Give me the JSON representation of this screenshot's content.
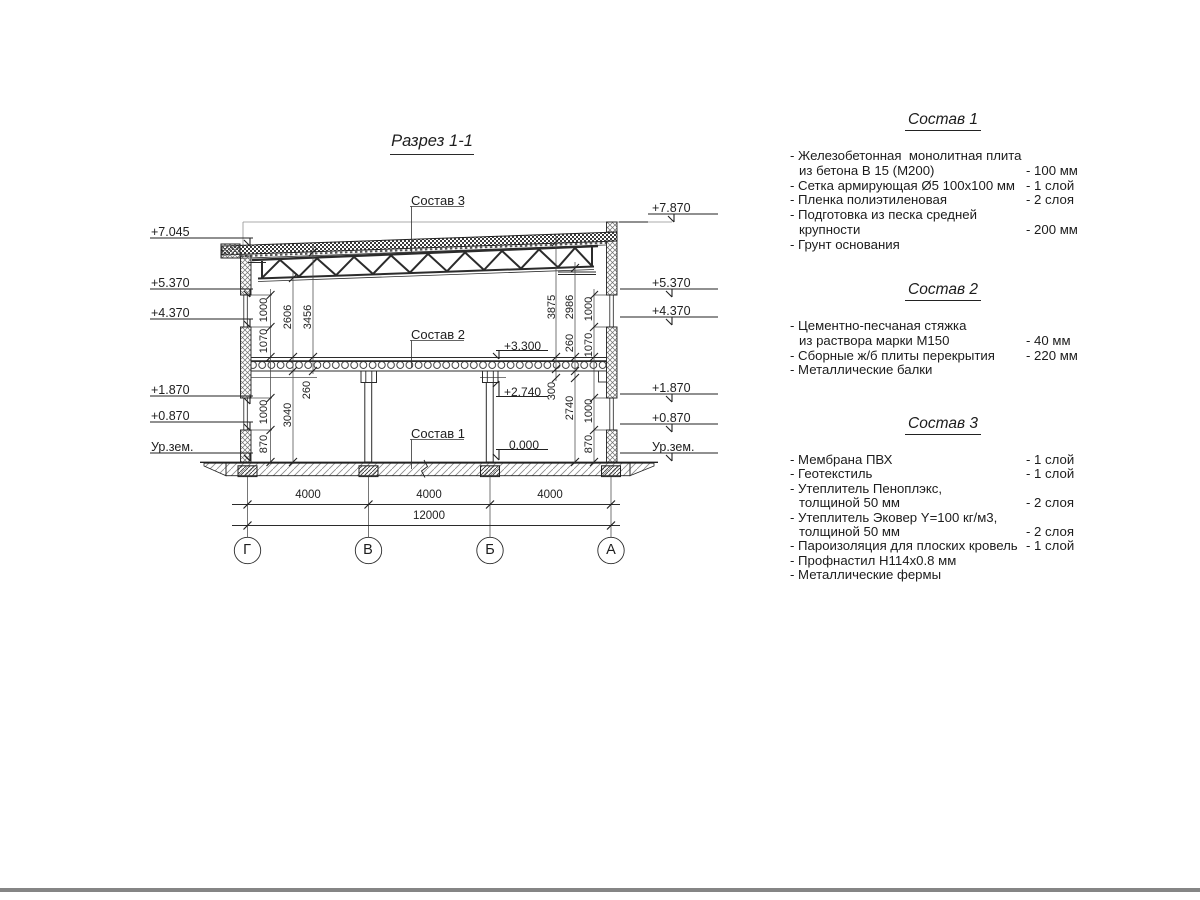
{
  "ink_color": "#222222",
  "bottom_edge_color": "#858585",
  "drawing": {
    "title": "Разрез 1-1",
    "levels_left": [
      "+7.045",
      "+5.370",
      "+4.370",
      "+1.870",
      "+0.870",
      "Ур.зем."
    ],
    "levels_right": [
      "+7.870",
      "+5.370",
      "+4.370",
      "+1.870",
      "+0.870",
      "Ур.зем."
    ],
    "levels_internal": [
      "+3.300",
      "+2.740",
      "0.000"
    ],
    "callouts": [
      "Состав 3",
      "Состав 2",
      "Состав 1"
    ],
    "dims_left": [
      "1000",
      "1070",
      "2606",
      "3456",
      "260",
      "3040",
      "1000",
      "870"
    ],
    "dims_right": [
      "3875",
      "2986",
      "1000",
      "260",
      "1070",
      "300",
      "2740",
      "1000",
      "870"
    ],
    "dims_bottom": [
      "4000",
      "4000",
      "4000",
      "12000"
    ],
    "axes": [
      "Г",
      "В",
      "Б",
      "А"
    ]
  },
  "lists": [
    {
      "title": "Состав 1",
      "rows": [
        {
          "t": "- Железобетонная  монолитная плита",
          "v": ""
        },
        {
          "t": "из бетона В 15 (М200)",
          "v": "- 100 мм"
        },
        {
          "t": "- Сетка армирующая Ø5 100х100 мм",
          "v": "- 1 слой"
        },
        {
          "t": "- Пленка полиэтиленовая",
          "v": "- 2 слоя"
        },
        {
          "t": "- Подготовка из песка средней",
          "v": ""
        },
        {
          "t": "крупности",
          "v": "- 200 мм"
        },
        {
          "t": "- Грунт основания",
          "v": ""
        }
      ]
    },
    {
      "title": "Состав 2",
      "rows": [
        {
          "t": "- Цементно-песчаная стяжка",
          "v": ""
        },
        {
          "t": "из раствора марки М150",
          "v": "- 40 мм"
        },
        {
          "t": "- Сборные ж/б плиты перекрытия",
          "v": "- 220 мм"
        },
        {
          "t": "- Металлические балки",
          "v": ""
        }
      ]
    },
    {
      "title": "Состав 3",
      "rows": [
        {
          "t": "- Мембрана ПВХ",
          "v": "- 1 слой"
        },
        {
          "t": "- Геотекстиль",
          "v": "- 1 слой"
        },
        {
          "t": "- Утеплитель Пеноплэкс,",
          "v": ""
        },
        {
          "t": "толщиной 50 мм",
          "v": "- 2 слоя"
        },
        {
          "t": "- Утеплитель Эковер Y=100 кг/м3,",
          "v": ""
        },
        {
          "t": "толщиной 50 мм",
          "v": "- 2 слоя"
        },
        {
          "t": "- Пароизоляция для плоских кровель",
          "v": "- 1 слой"
        },
        {
          "t": "- Профнастил Н114х0.8 мм",
          "v": ""
        },
        {
          "t": "- Металлические фермы",
          "v": ""
        }
      ]
    }
  ]
}
